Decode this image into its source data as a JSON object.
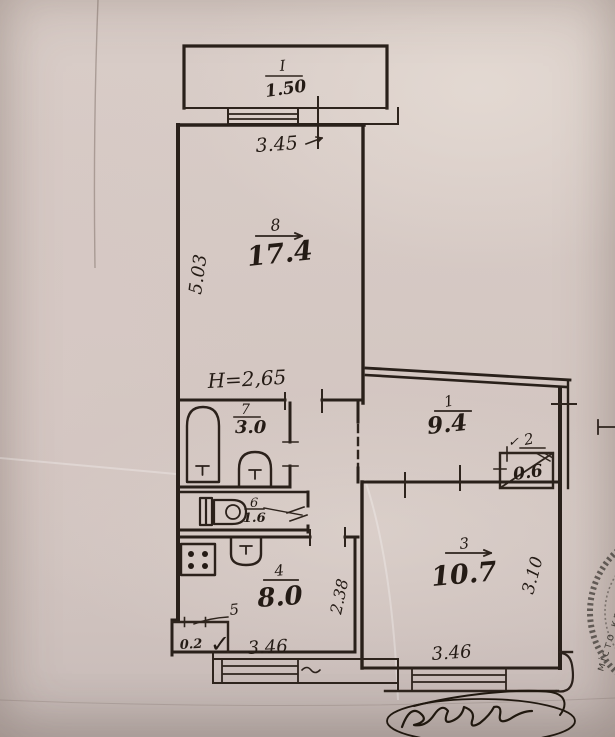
{
  "plan": {
    "rooms": {
      "balcony": {
        "num": "I",
        "area": "1.50"
      },
      "living": {
        "num": "8",
        "area": "17.4"
      },
      "bath": {
        "num": "7",
        "area": "3.0"
      },
      "wc": {
        "num": "6",
        "area": "1.6"
      },
      "hall": {
        "num": "1",
        "area": "9.4"
      },
      "closet": {
        "num": "2",
        "area": "0.6"
      },
      "room3": {
        "num": "3",
        "area": "10.7"
      },
      "kitchen": {
        "num": "4",
        "area": "8.0"
      },
      "pantry": {
        "num": "5",
        "area": "0.2"
      }
    },
    "dims": {
      "living_width": "3.45",
      "living_depth": "5.03",
      "height_note": "H=2,65",
      "kitchen_divider": "2.38",
      "room3_depth": "3.10",
      "room3_width": "3.46",
      "kitchen_width": "3.46"
    },
    "marks": {
      "pantry_check": "✓",
      "closet_check": "✓"
    },
    "stamp_text": "місто кри"
  }
}
